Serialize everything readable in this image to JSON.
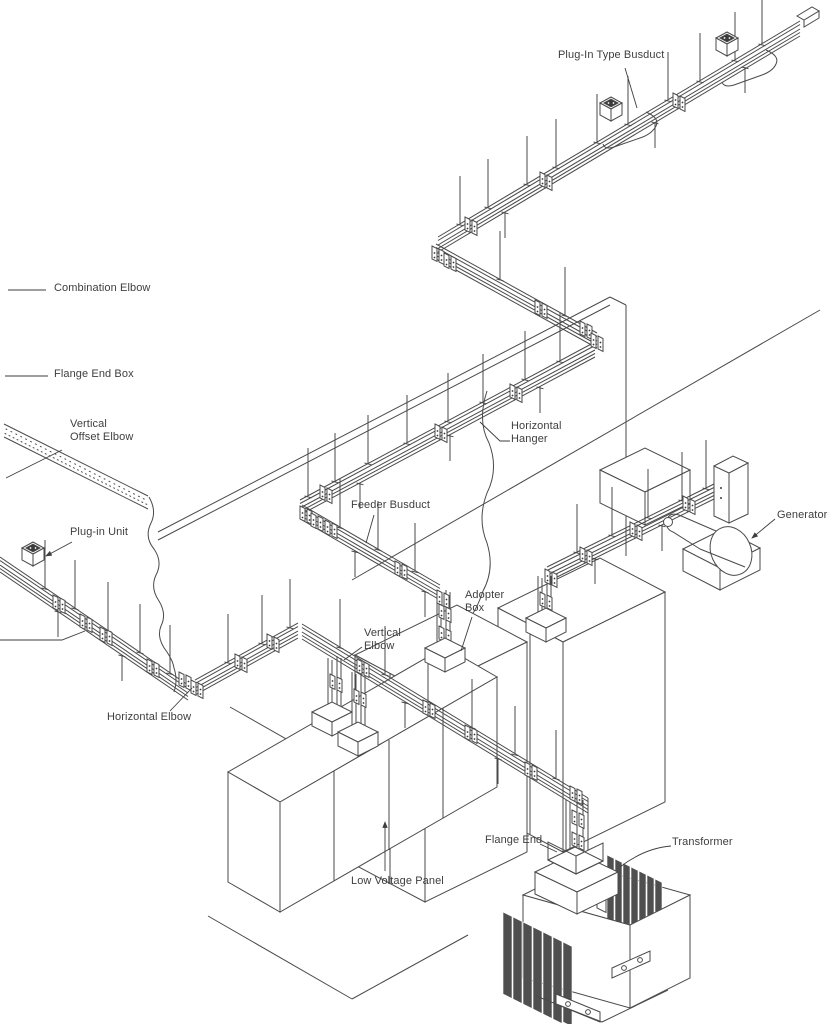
{
  "figure": {
    "type": "isometric line drawing",
    "subject": "busduct power distribution installation diagram",
    "background_color": "#ffffff",
    "line_color": "#4a4a4a",
    "text_color": "#3e3e3e"
  },
  "labels": {
    "plug_in_type_busduct": {
      "text": "Plug-In Type Busduct"
    },
    "combination_elbow": {
      "text": "Combination Elbow"
    },
    "flange_end_box": {
      "text": "Flange End Box"
    },
    "vertical_offset_elbow": {
      "text": "Vertical\nOffset Elbow"
    },
    "plug_in_unit": {
      "text": "Plug-in Unit"
    },
    "horizontal_elbow": {
      "text": "Horizontal Elbow"
    },
    "feeder_busduct": {
      "text": "Feeder Busduct"
    },
    "horizontal_hanger": {
      "text": "Horizontal\nHanger"
    },
    "vertical_elbow": {
      "text": "Vertical\nElbow"
    },
    "adopter_box": {
      "text": "Adopter\nBox"
    },
    "generator": {
      "text": "Generator"
    },
    "low_voltage_panel": {
      "text": "Low Voltage Panel"
    },
    "flange_end": {
      "text": "Flange End"
    },
    "transformer": {
      "text": "Transformer"
    }
  }
}
